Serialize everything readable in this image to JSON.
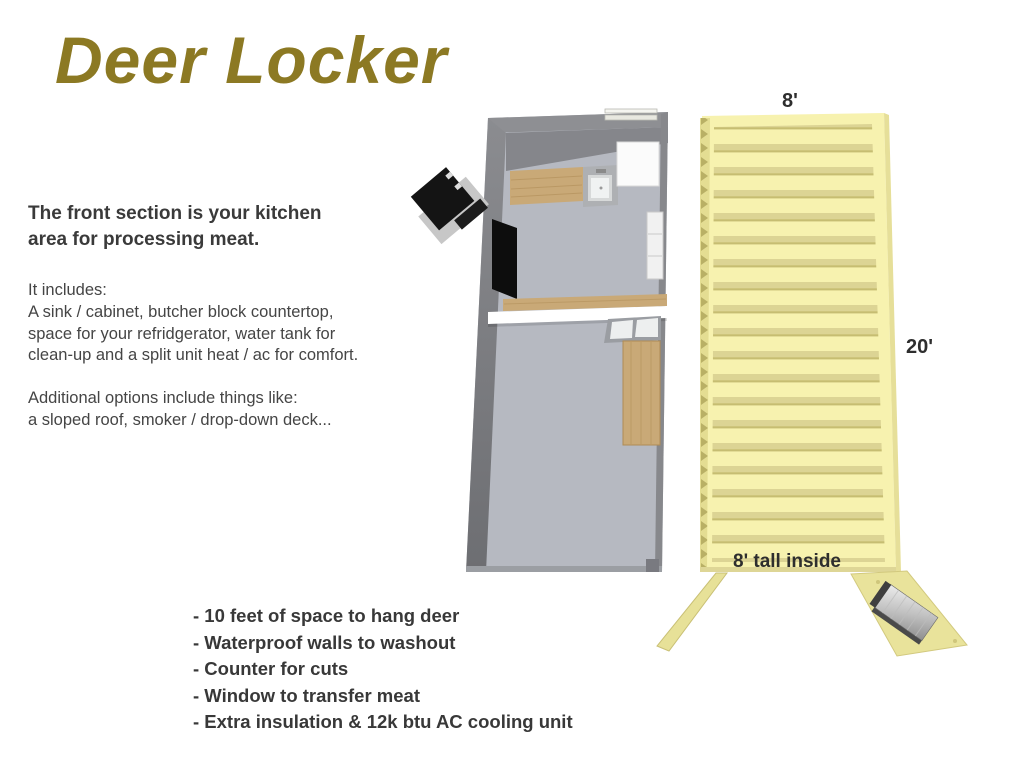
{
  "page": {
    "title": "Deer Locker"
  },
  "intro": {
    "heading": "The front section is your kitchen\narea for processing meat.",
    "includes": "It includes:\nA sink / cabinet, butcher block countertop,\nspace for your refridgerator, water tank for\nclean-up and a split unit heat / ac for comfort.",
    "options": "Additional options include things like:\na sloped roof, smoker / drop-down deck..."
  },
  "dimensions": {
    "width": "8'",
    "length": "20'",
    "height": "8' tall inside"
  },
  "features": [
    "- 10 feet of space to hang deer",
    "- Waterproof walls to washout",
    "- Counter for cuts",
    "- Window to transfer meat",
    "- Extra insulation & 12k btu AC cooling unit"
  ],
  "colors": {
    "title_gold": "#8c7923",
    "body_text": "#3e3e3e",
    "roof_yellow": "#f7f2af",
    "roof_stripe": "#dcd494",
    "wall_gray": "#8e8f93",
    "floor_gray": "#b6b9c1",
    "wood": "#c9a977"
  }
}
